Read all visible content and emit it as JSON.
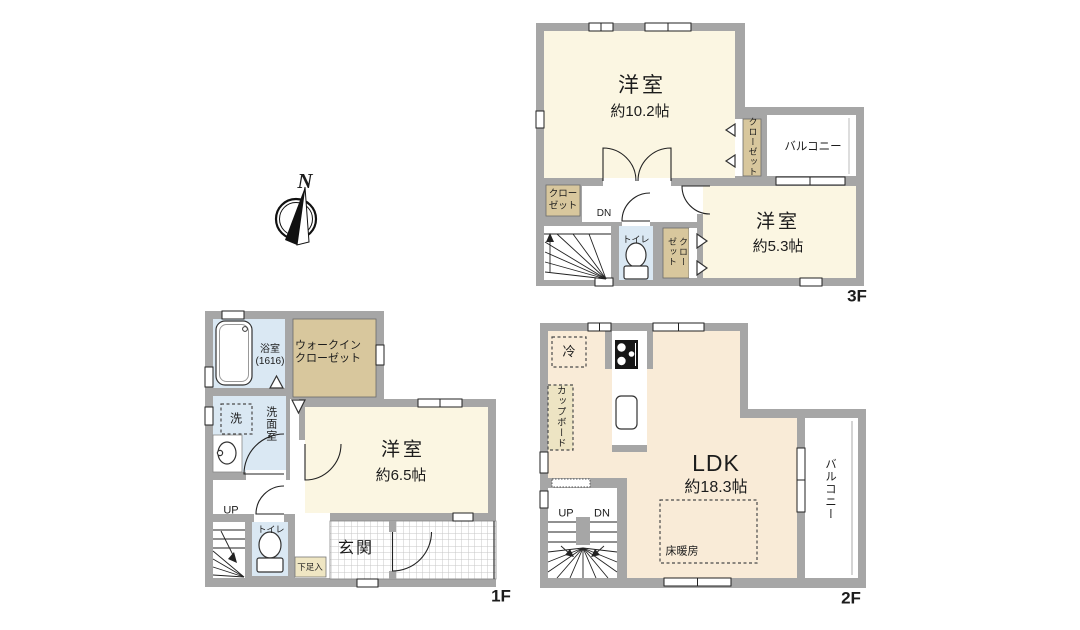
{
  "compass": {
    "north": "N"
  },
  "palette": {
    "wall_gray": "#a6a6a6",
    "room_cream": "#FBF6E2",
    "ldk_peach": "#F9EBD7",
    "closet_tan": "#D8C79D",
    "pale_tan": "#EFE6C3",
    "wet_blue": "#DAE8F3",
    "line": "#222222"
  },
  "floor3": {
    "label": "3F",
    "bedroom_main_name": "洋室",
    "bedroom_main_size": "約10.2帖",
    "bedroom_small_name": "洋室",
    "bedroom_small_size": "約5.3帖",
    "balcony": "バルコニー",
    "closet_wall": "クローゼット",
    "closet_left": "クローゼット",
    "closet_hall": "クローゼット",
    "toilet": "トイレ",
    "dn": "DN"
  },
  "floor2": {
    "label": "2F",
    "ldk_name": "LDK",
    "ldk_size": "約18.3帖",
    "floor_heating": "床暖房",
    "fridge": "冷",
    "cupboard": "カップボード",
    "balcony": "バルコニー",
    "up": "UP",
    "dn": "DN"
  },
  "floor1": {
    "label": "1F",
    "bedroom_name": "洋室",
    "bedroom_size": "約6.5帖",
    "bath": "浴室\n(1616)",
    "washroom": "洗面室",
    "washer": "洗",
    "wic": "ウォークインクローゼット",
    "toilet": "トイレ",
    "entrance": "玄関",
    "shoe_cabinet": "下足入",
    "up": "UP"
  }
}
